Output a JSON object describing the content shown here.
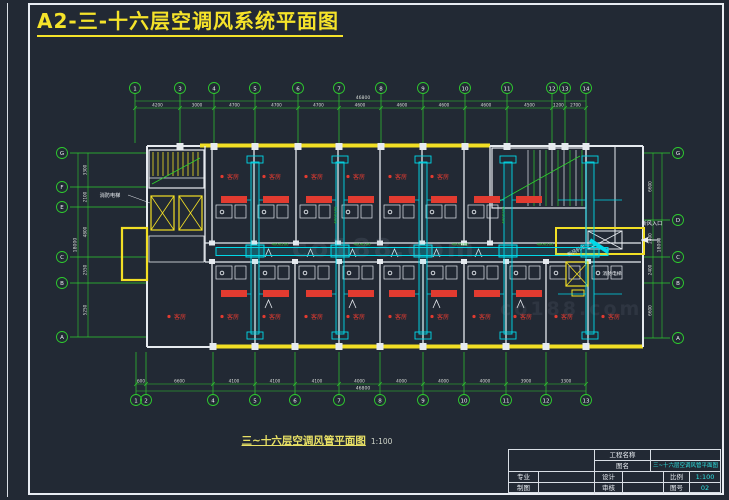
{
  "sheet": {
    "title": "A2-三-十六层空调风系统平面图",
    "caption": "三~十六层空调风管平面图",
    "caption_scale": "1:100",
    "watermark": "co188.com"
  },
  "colors": {
    "background": "#222934",
    "grid": "#2ecc2e",
    "dim_text": "#d9ded9",
    "wall": "#e6eaef",
    "duct": "#00d9e8",
    "accent": "#f2df25",
    "equipment_red": "#e23b30",
    "value_cyan": "#2fe3e3",
    "title_yellow": "#f5e32a"
  },
  "grid": {
    "top_bubbles": [
      "1",
      "3",
      "4",
      "5",
      "6",
      "7",
      "8",
      "9",
      "10",
      "11",
      "12",
      "13",
      "14"
    ],
    "bottom_bubbles": [
      "1",
      "2",
      "4",
      "5",
      "6",
      "7",
      "8",
      "9",
      "10",
      "11",
      "12",
      "13"
    ],
    "left_bubbles": [
      "G",
      "F",
      "E",
      "C",
      "B",
      "A"
    ],
    "right_bubbles": [
      "G",
      "D",
      "C",
      "B",
      "A"
    ],
    "top_dims": [
      "4200",
      "3000",
      "4700",
      "4700",
      "4700",
      "4600",
      "4600",
      "4600",
      "4600",
      "4500",
      "1200",
      "2700"
    ],
    "top_total": "46800",
    "bottom_dims": [
      "600",
      "6600",
      "4100",
      "4100",
      "4100",
      "4000",
      "4000",
      "4000",
      "4000",
      "3900",
      "3300"
    ],
    "bottom_total": "46800",
    "left_dims": [
      "3300",
      "2100",
      "4800",
      "2550",
      "5250"
    ],
    "left_total": "18000",
    "right_dims": [
      "6600",
      "2400",
      "2400",
      "6600"
    ],
    "right_total": "18000"
  },
  "plan": {
    "room_label": "客房",
    "duct_size_label": "400X200",
    "labels": {
      "fire_elevator": "消防电梯",
      "fresh_air_inlet": "新风入口",
      "ahu_unit": "新风机组"
    }
  },
  "titleblock": {
    "project_label": "工程名称",
    "project_value": "",
    "drawing_label": "图名",
    "drawing_value": "三~十六层空调风管平面图",
    "specialty_label": "专业",
    "specialty_value": "",
    "design_label": "设计",
    "design_value": "",
    "scale_label": "比例",
    "scale_value": "1:100",
    "draft_label": "制图",
    "draft_value": "",
    "review_label": "审核",
    "review_value": "",
    "sheet_no_label": "图号",
    "sheet_no_value": "02"
  }
}
